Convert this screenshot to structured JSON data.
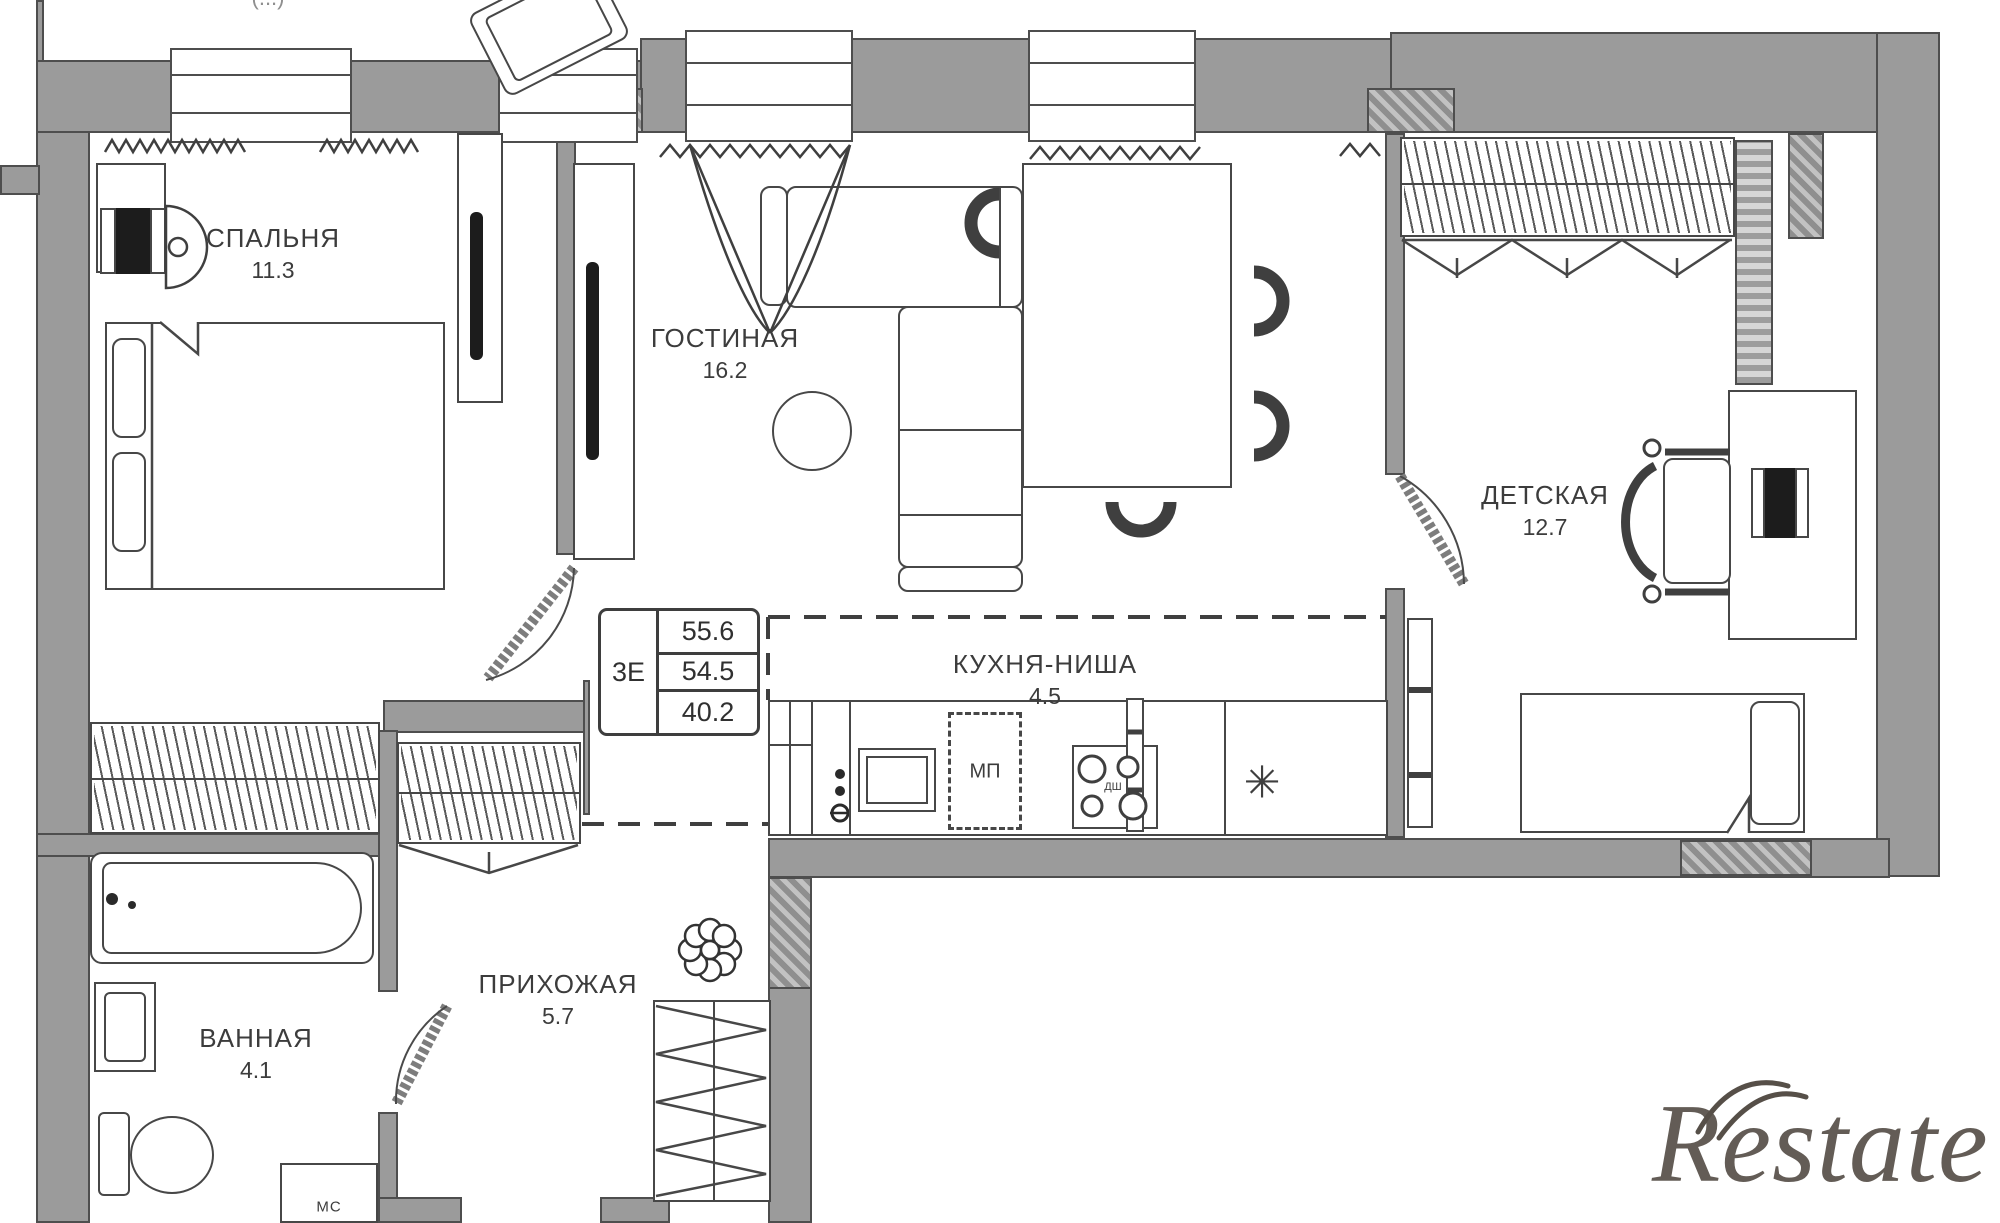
{
  "plan": {
    "rooms": [
      {
        "name": "СПАЛЬНЯ",
        "area": "11.3"
      },
      {
        "name": "ГОСТИНАЯ",
        "area": "16.2"
      },
      {
        "name": "КУХНЯ-НИША",
        "area": "4.5"
      },
      {
        "name": "ДЕТСКАЯ",
        "area": "12.7"
      },
      {
        "name": "ВАННАЯ",
        "area": "4.1"
      },
      {
        "name": "ПРИХОЖАЯ",
        "area": "5.7"
      }
    ],
    "info_table": {
      "left_label": "3Е",
      "rows": [
        "55.6",
        "54.5",
        "40.2"
      ]
    },
    "markers": {
      "kitchen_mp": "МП",
      "stove_small": "ДШ",
      "star": "✳",
      "bathroom_ms": "МС",
      "top_truncated": "(...)"
    }
  },
  "watermark": {
    "text": "Restate",
    "color": "#564f48"
  },
  "colors": {
    "wall_fill": "#9b9b9b",
    "wall_outline": "#4e4e4e",
    "line": "#3f3f3f",
    "label_text": "#3c3c3c"
  }
}
